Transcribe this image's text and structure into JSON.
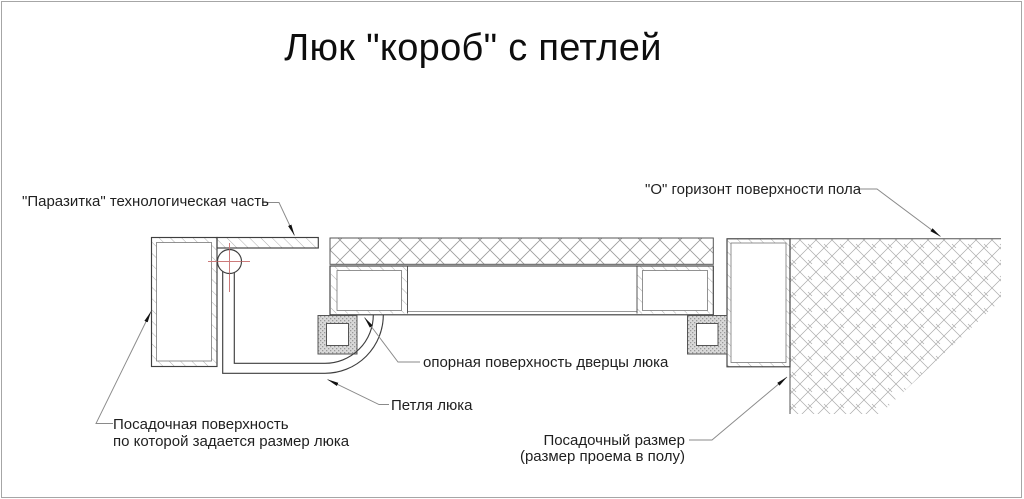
{
  "title": "Люк \"короб\" с петлей",
  "labels": {
    "parazitka": "\"Паразитка\" технологическая часть",
    "horizon": "\"О\" горизонт поверхности пола",
    "opornaya": "опорная поверхность дверцы люка",
    "petlya": "Петля люка",
    "posadochnaya_line1": "Посадочная поверхность",
    "posadochnaya_line2": "по которой задается размер люка",
    "posadochny_line1": "Посадочный размер",
    "posadochny_line2": "(размер проема в полу)"
  },
  "drawing": {
    "colors": {
      "outline": "#3f3f3f",
      "line": "#555555",
      "hatch": "#9a9a9a",
      "leader": "#8a8a8a",
      "arrow": "#111111",
      "centerline": "#cc7a7a",
      "stipple-base": "#d9d9d9",
      "stipple-dot": "#999999",
      "border": "#a6a6a6",
      "text": "#1f1f1f"
    }
  }
}
